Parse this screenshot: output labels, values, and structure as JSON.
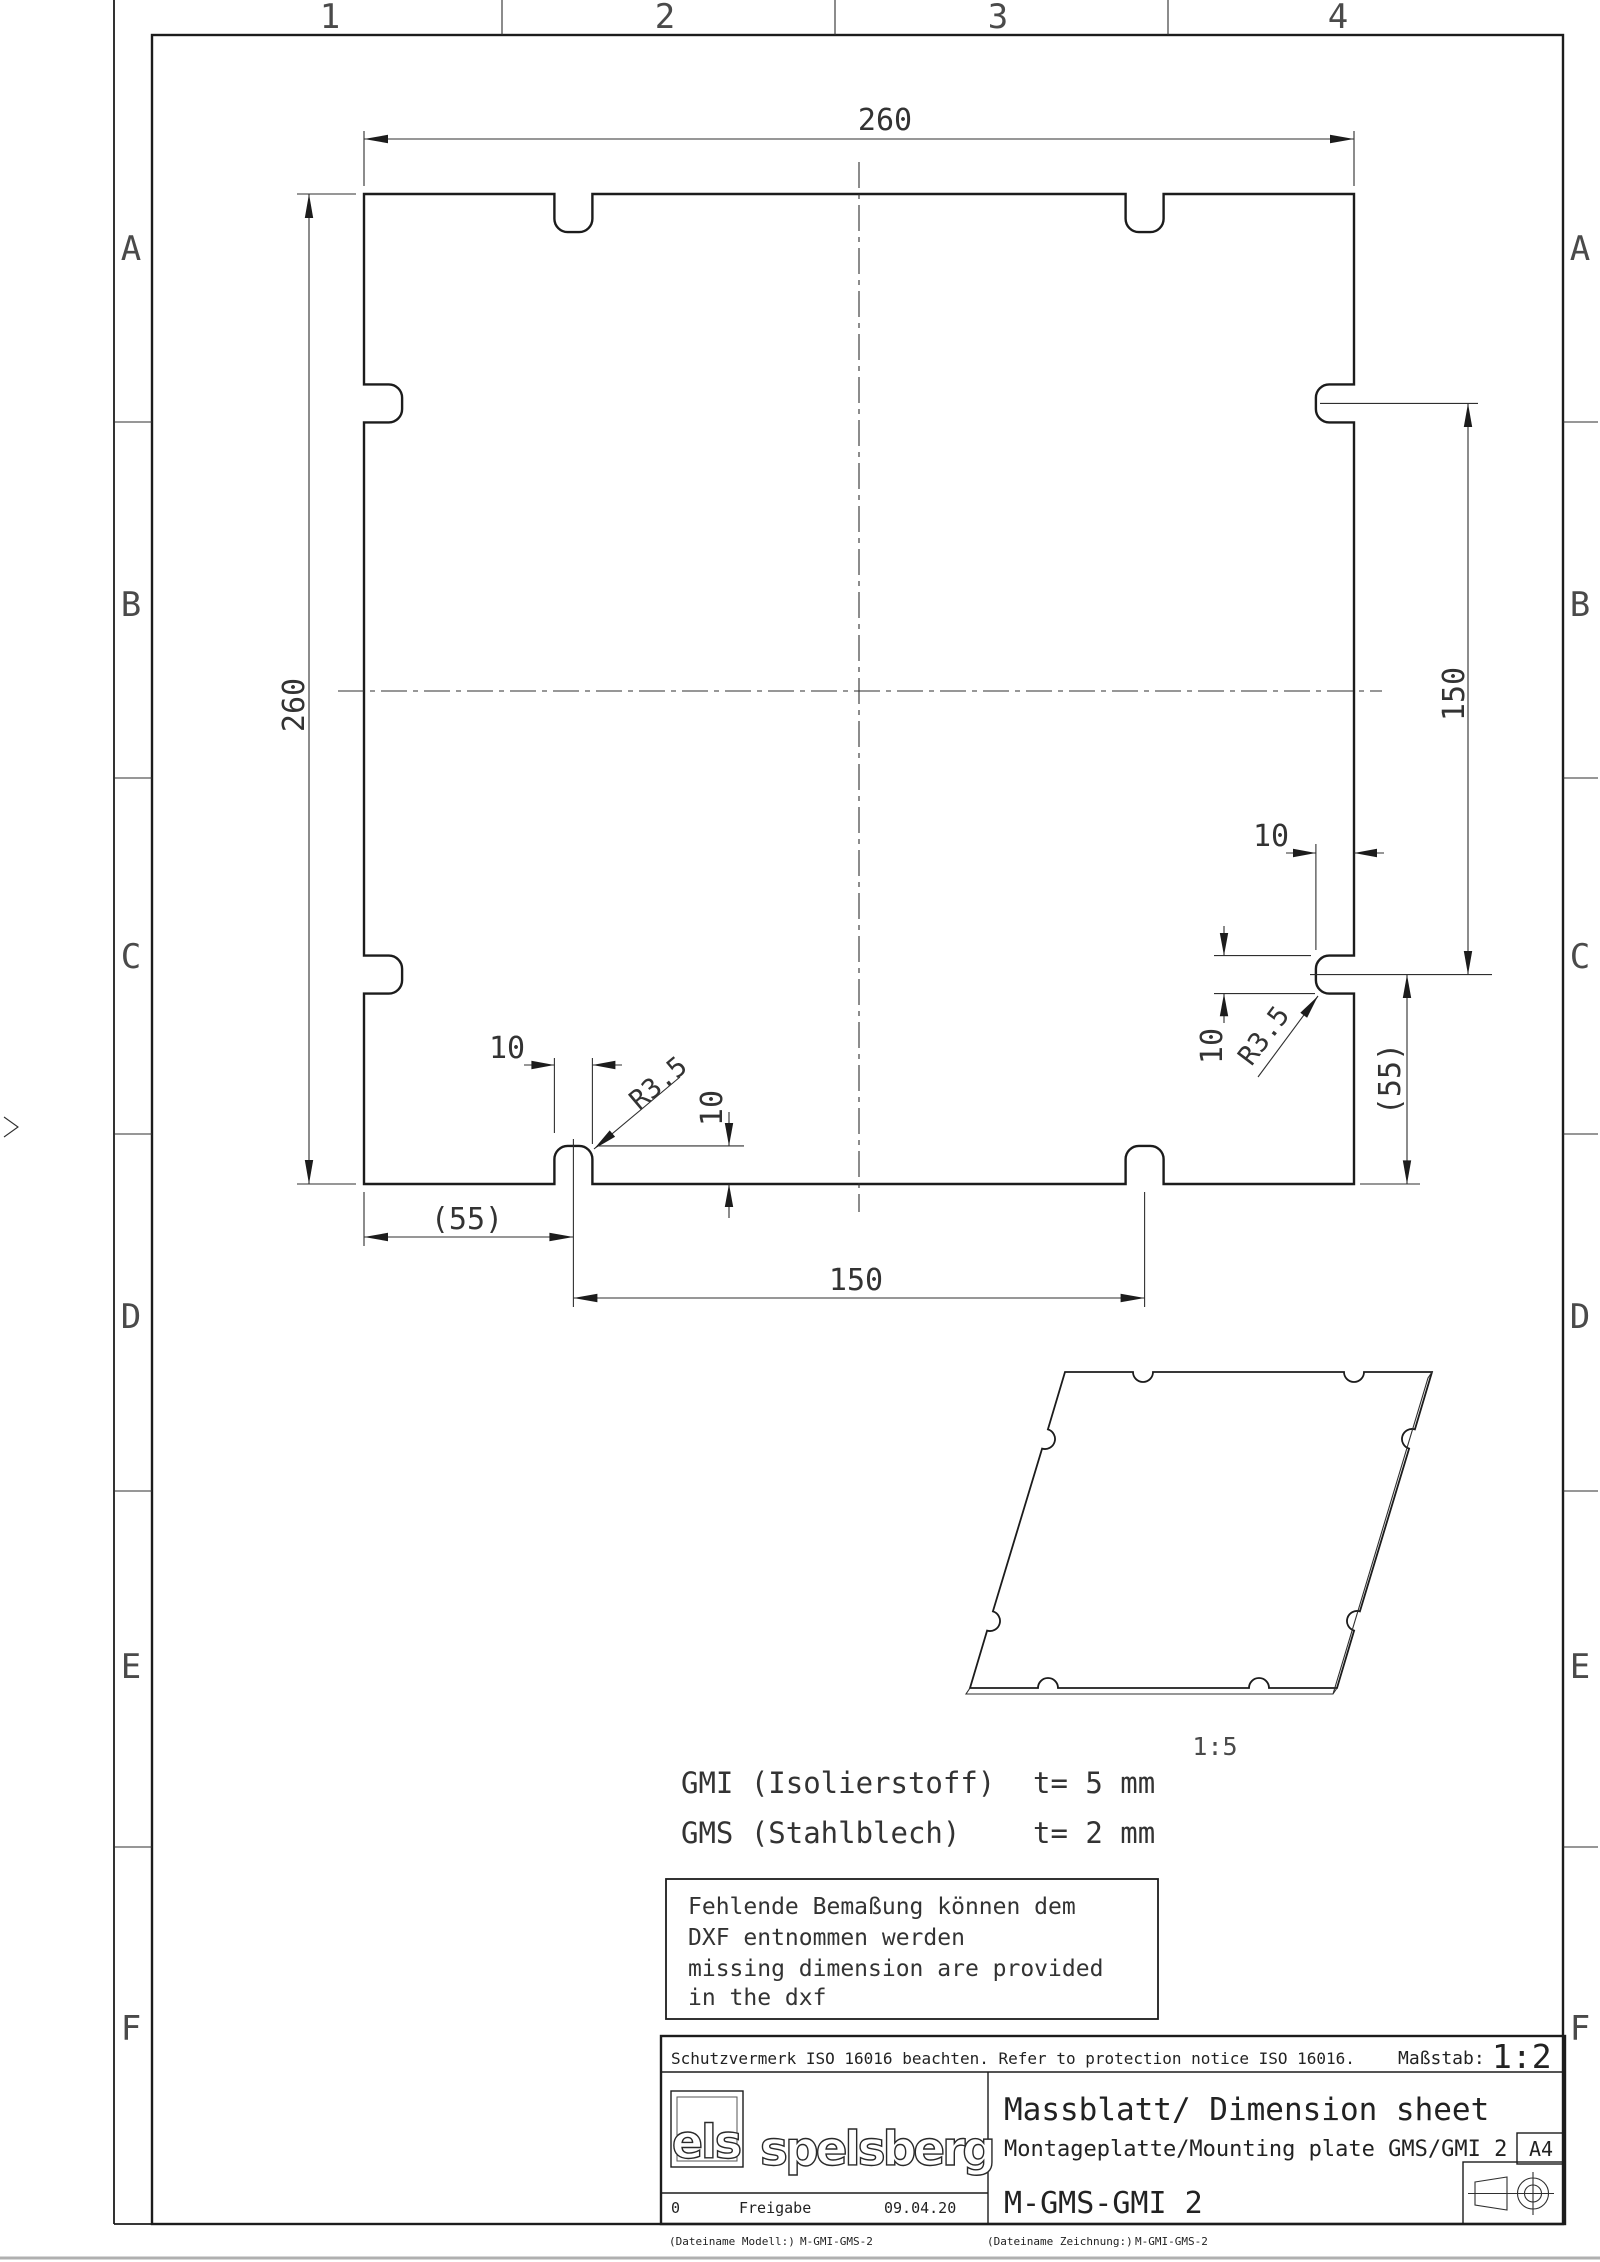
{
  "sheet": {
    "columns": [
      "1",
      "2",
      "3",
      "4"
    ],
    "rows": [
      "A",
      "B",
      "C",
      "D",
      "E",
      "F"
    ]
  },
  "drawing": {
    "dim_width_top": "260",
    "dim_height_left": "260",
    "right": {
      "spacing": "150",
      "offset": "(55)",
      "notch_depth": "10",
      "notch_width": "10",
      "radius": "R3.5"
    },
    "bottom": {
      "offset": "(55)",
      "spacing": "150",
      "notch_width": "10",
      "notch_depth": "10",
      "radius": "R3.5"
    }
  },
  "iso": {
    "scale": "1:5"
  },
  "materials": [
    {
      "code": "GMI (Isolierstoff)",
      "thickness": "t= 5 mm"
    },
    {
      "code": "GMS (Stahlblech)",
      "thickness": "t= 2 mm"
    }
  ],
  "note": {
    "lines": [
      "Fehlende Bemaßung können dem",
      "DXF entnommen werden",
      "missing dimension are provided",
      "in the dxf"
    ]
  },
  "title_block": {
    "protection": "Schutzvermerk ISO 16016 beachten. Refer to protection notice ISO 16016.",
    "scale_label": "Maßstab:",
    "scale_value": "1:2",
    "logo_primary": "els",
    "logo_secondary": "spelsberg",
    "revision": "0",
    "release": "Freigabe",
    "date": "09.04.20",
    "doc_type": "Massblatt/ Dimension sheet",
    "part_title": "Montageplatte/Mounting plate GMS/GMI 2",
    "format": "A4",
    "drawing_no": "M-GMS-GMI 2"
  },
  "footer": {
    "model_label": "(Dateiname Modell:)",
    "model_value": "M-GMI-GMS-2",
    "drawing_label": "(Dateiname Zeichnung:)",
    "drawing_value": "M-GMI-GMS-2"
  }
}
